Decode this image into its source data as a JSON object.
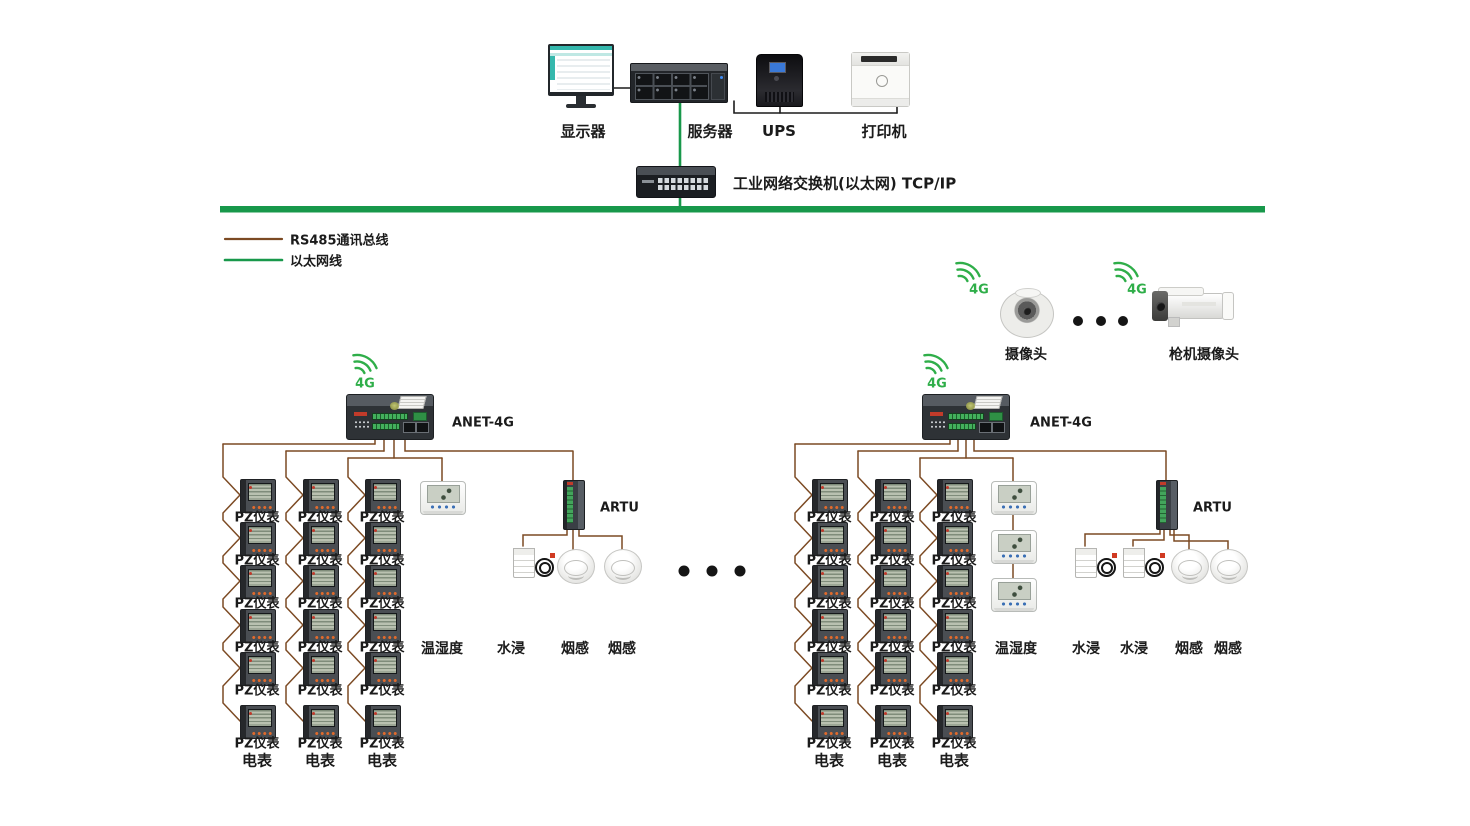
{
  "colors": {
    "rs485": "#7c4a23",
    "ethernet": "#18984b",
    "wifi": "#2fae49",
    "wire": "#1c1c1c",
    "dots": "#151515"
  },
  "legend": {
    "rs485_label": "RS485通讯总线",
    "ethernet_label": "以太网线"
  },
  "top": {
    "monitor_label": "显示器",
    "server_label": "服务器",
    "ups_label": "UPS",
    "printer_label": "打印机",
    "switch_label": "工业网络交换机(以太网) TCP/IP"
  },
  "wifi_label": "4G",
  "gateway_label": "ANET-4G",
  "meter": {
    "unit_label": "PZ仪表",
    "column_label": "电表",
    "rows_per_column": 6,
    "columns_per_gateway": 3
  },
  "sensors": {
    "temp_humidity_label": "温湿度",
    "water_label": "水浸",
    "smoke_label": "烟感",
    "artu_label": "ARTU"
  },
  "cameras": {
    "dome_label": "摄像头",
    "bullet_label": "枪机摄像头"
  }
}
